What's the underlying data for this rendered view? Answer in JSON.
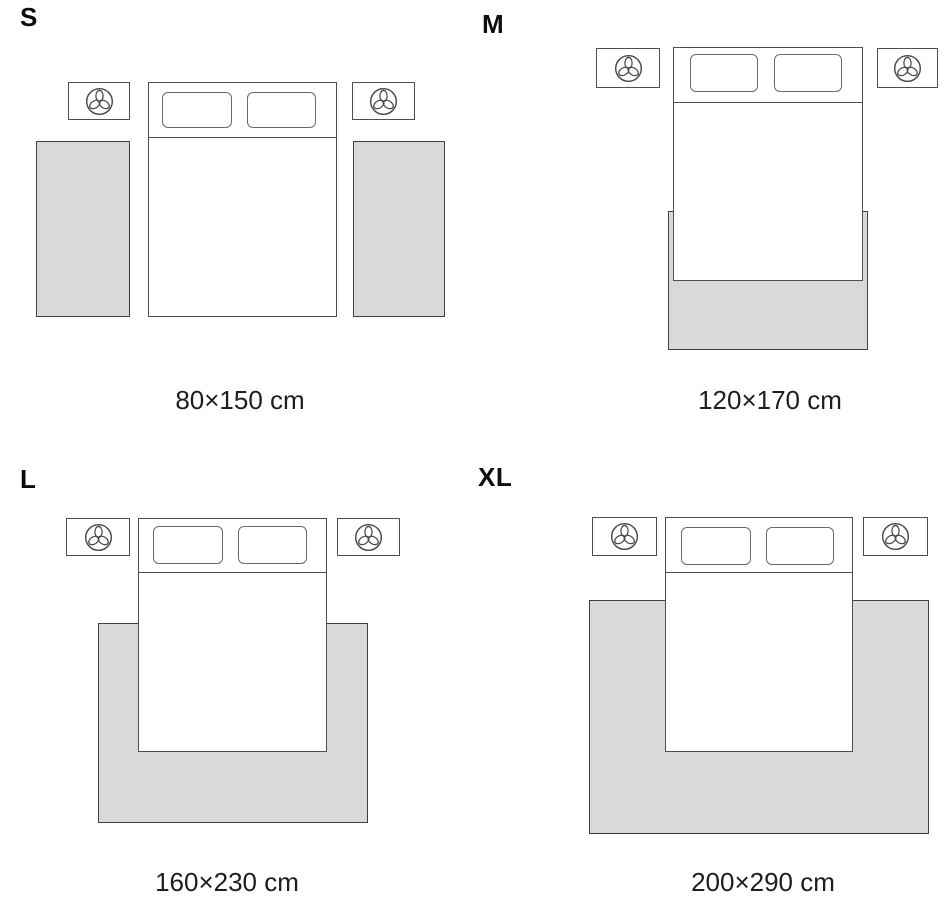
{
  "panels": [
    {
      "id": "s",
      "label": "S",
      "caption": "80×150 cm"
    },
    {
      "id": "m",
      "label": "M",
      "caption": "120×170 cm"
    },
    {
      "id": "l",
      "label": "L",
      "caption": "160×230 cm"
    },
    {
      "id": "xl",
      "label": "XL",
      "caption": "200×290 cm"
    }
  ],
  "icons": {
    "nightstand_icon": "plant-top-view-icon"
  },
  "colors": {
    "rug_fill": "#d9d9d9",
    "rug_outline": "#3f3f3f",
    "outline": "#4f4f4f",
    "text": "#1e1e1e"
  }
}
